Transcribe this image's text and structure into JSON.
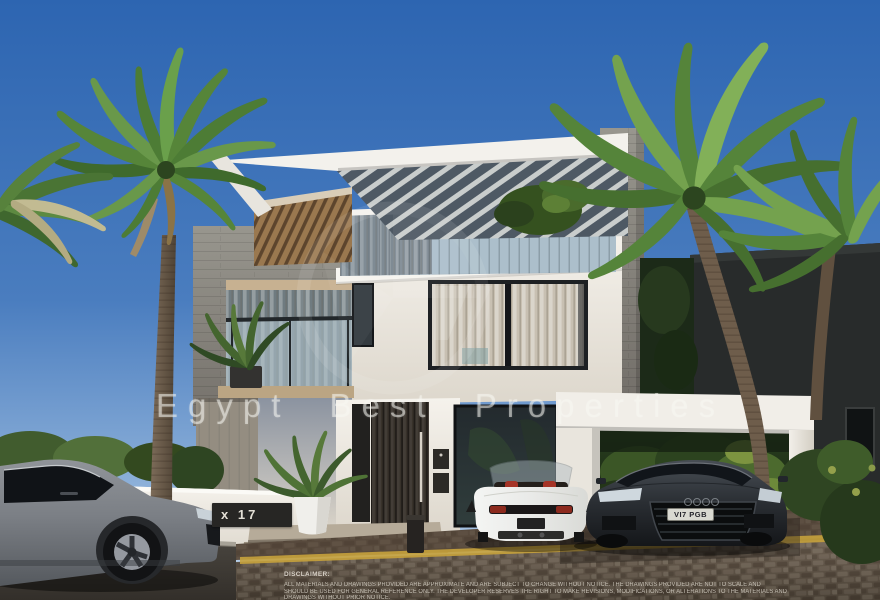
{
  "image": {
    "type": "architectural-render",
    "description": "Modern three-storey white villa with slatted pergola roof, glass balconies with plants, palm trees, a white roadster and dark sedan parked under a white carport, and a grey SUV on the street"
  },
  "watermark": {
    "text": "Egypt Best Properties",
    "color": "#FFFFFF"
  },
  "villa": {
    "number_sign": "x 17"
  },
  "cars": {
    "sedan_plate": "VI7 PGB"
  },
  "disclaimer": {
    "title": "DISCLAIMER:",
    "lines": [
      "ALL MATERIALS AND DRAWINGS PROVIDED ARE APPROXIMATE AND ARE SUBJECT TO CHANGE WITHOUT NOTICE. THE DRAWINGS PROVIDED ARE NOT TO SCALE AND",
      "SHOULD BE USED FOR GENERAL REFERENCE ONLY. THE DEVELOPER RESERVES THE RIGHT TO MAKE REVISIONS, MODIFICATIONS, OR ALTERATIONS TO THE MATERIALS AND",
      "DRAWINGS WITHOUT PRIOR NOTICE."
    ]
  },
  "palette": {
    "sky_top": "#2d65b1",
    "sky_horizon": "#cadcee",
    "wall_white": "#f2efe9",
    "concrete_grey": "#8e8c82",
    "wood_slats": "#9a784f",
    "palm_green": "#5d8a41",
    "curb_yellow": "#c7a23c",
    "seat_red": "#a53427"
  }
}
